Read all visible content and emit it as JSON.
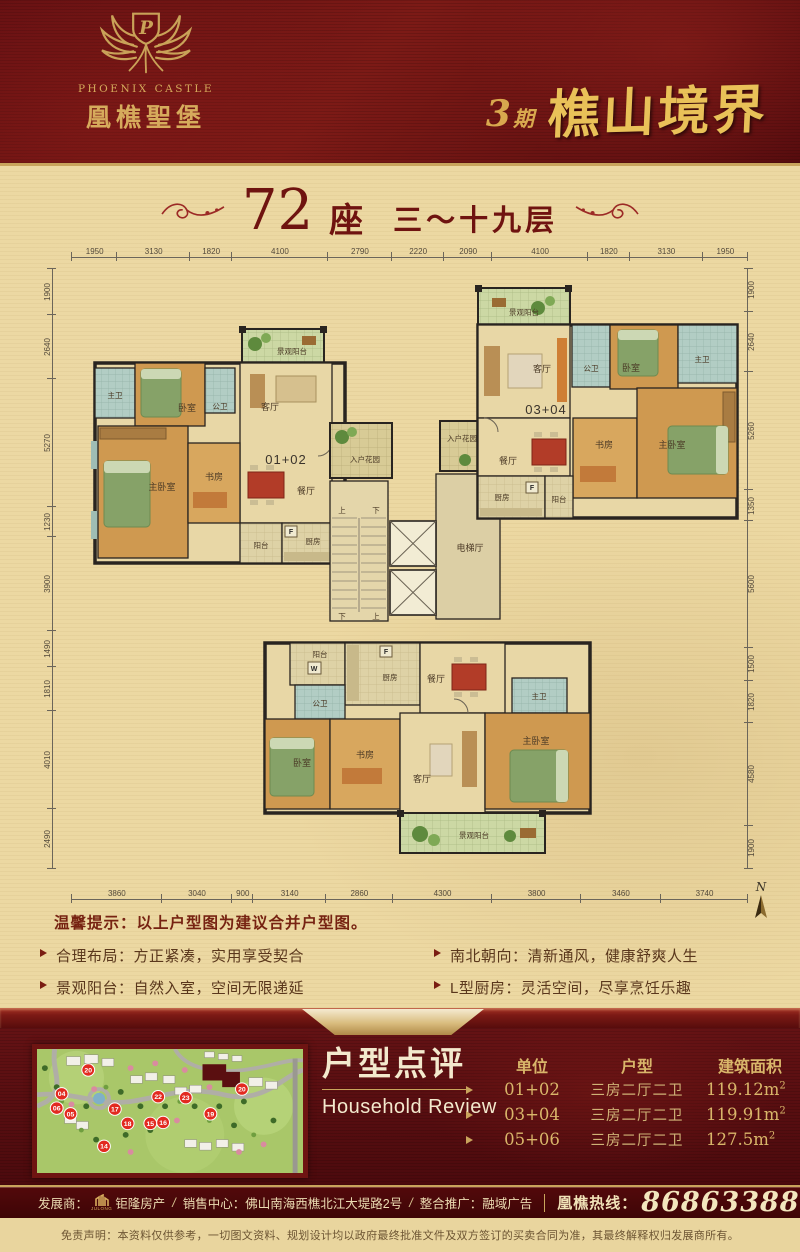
{
  "header": {
    "logo_monogram": "P",
    "brand_en": "PHOENIX CASTLE",
    "brand_cn": "凰樵聖堡",
    "phase_num": "3",
    "phase_unit": "期",
    "project_name": "樵山境界"
  },
  "title": {
    "number": "72",
    "suffix": "座",
    "floors": "三～十九层"
  },
  "plan": {
    "dims_top": [
      "1950",
      "3130",
      "1820",
      "4100",
      "2790",
      "2220",
      "2090",
      "4100",
      "1820",
      "3130",
      "1950"
    ],
    "dims_bottom": [
      "3860",
      "3040",
      "900",
      "3140",
      "2860",
      "4300",
      "3800",
      "3460",
      "3740"
    ],
    "dims_left": [
      "1900",
      "2640",
      "5270",
      "1230",
      "3900",
      "1490",
      "1810",
      "4010",
      "2490"
    ],
    "dims_right": [
      "1900",
      "2640",
      "5260",
      "1350",
      "5600",
      "1500",
      "1820",
      "4580",
      "1900"
    ],
    "north": "N",
    "units": {
      "left": "01+02",
      "right": "03+04",
      "bottom": "05+06"
    },
    "labels": {
      "view_balcony": "景观阳台",
      "balcony": "阳台",
      "kitchen": "厨房",
      "dining": "餐厅",
      "living": "客厅",
      "bedroom": "卧室",
      "master_bedroom": "主卧室",
      "study": "书房",
      "master_bath": "主卫",
      "public_bath": "公卫",
      "entry_garden": "入户花园",
      "elevator_hall": "电梯厅",
      "up": "上",
      "down": "下",
      "fridge": "F",
      "washer": "W"
    }
  },
  "tips": {
    "heading": "温馨提示：以上户型图为建议合并户型图。",
    "left": [
      "合理布局：方正紧凑，实用享受契合",
      "景观阳台：自然入室，空间无限递延",
      "主卧明卫：南向套房，尊雅舒适生活"
    ],
    "right": [
      "南北朝向：清新通风，健康舒爽人生",
      "L型厨房：灵活空间，尽享烹饪乐趣",
      "明朗飘窗：时尚前卫，乐享悠扬阳光"
    ]
  },
  "review": {
    "title_cn": "户型点评",
    "title_en": "Household Review",
    "headers": {
      "unit": "单位",
      "layout": "户型",
      "area": "建筑面积"
    },
    "rows": [
      {
        "unit": "01+02",
        "layout": "三房二厅二卫",
        "area": "119.12m",
        "sup": "2"
      },
      {
        "unit": "03+04",
        "layout": "三房二厅二卫",
        "area": "119.91m",
        "sup": "2"
      },
      {
        "unit": "05+06",
        "layout": "三房二厅二卫",
        "area": "127.5m",
        "sup": "2"
      }
    ]
  },
  "site_map": {
    "markers": [
      "20",
      "04",
      "06",
      "05",
      "17",
      "14",
      "18",
      "15",
      "16",
      "22",
      "23",
      "19",
      "20"
    ]
  },
  "footer": {
    "developer_label": "发展商：",
    "developer_logo": "JULONG",
    "developer": "钜隆房产",
    "sep1": "/",
    "sales_label": "销售中心：",
    "sales": "佛山南海西樵北江大堤路2号",
    "sep2": "/",
    "promo_label": "整合推广：",
    "promo": "融域广告",
    "hotline_label": "凰樵热线：",
    "hotline": "86863388"
  },
  "disclaimer": "免责声明：本资料仅供参考，一切图文资料、规划设计均以政府最终批准文件及双方签订的买卖合同为准，其最终解释权归发展商所有。",
  "colors": {
    "maroon": "#5f0f10",
    "gold": "#c9a45c",
    "beige": "#ecd8a2",
    "dark_red_text": "#6b1412"
  }
}
